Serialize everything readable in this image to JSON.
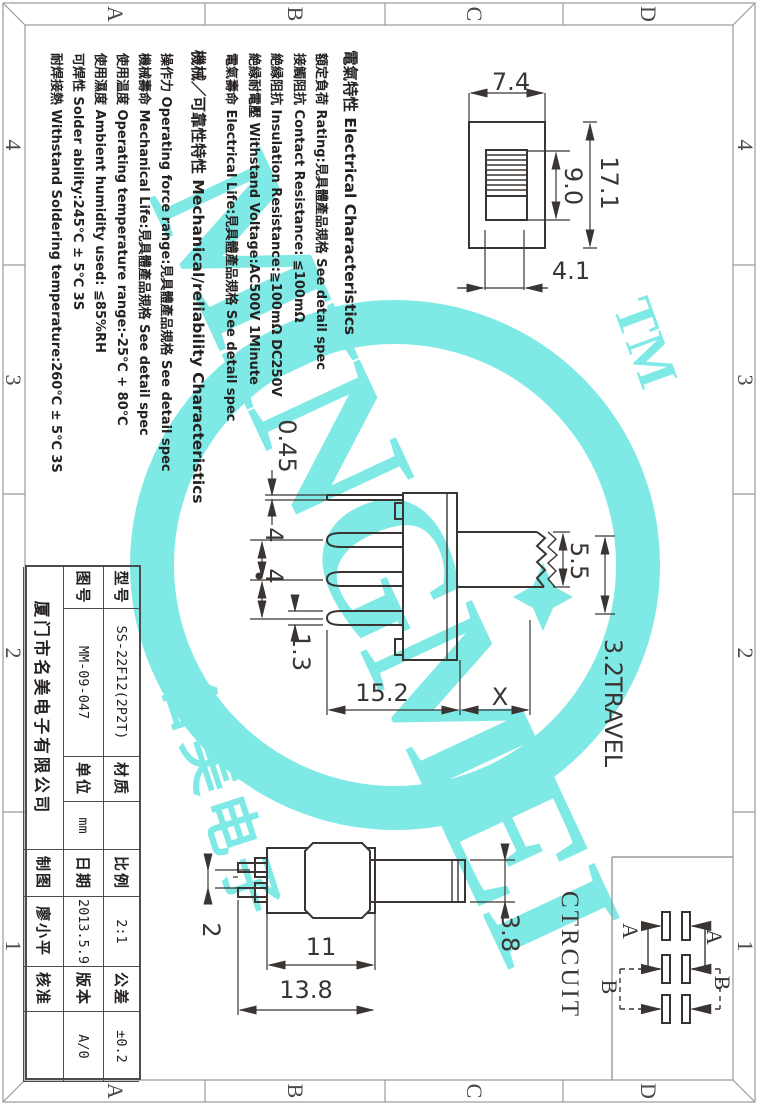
{
  "zones": {
    "cols": [
      "A",
      "B",
      "C",
      "D"
    ],
    "rows": [
      "4",
      "3",
      "2",
      "1"
    ]
  },
  "watermark": {
    "brand": "MINGMEI",
    "tm": "TM",
    "cn": "名美电子",
    "color": "#7fe9e6"
  },
  "specs": {
    "electrical_title": "電氣特性 Electrical Characteristics",
    "electrical": [
      "額定負荷 Rating:見具體產品規格 See detail spec",
      "接觸阻抗 Contact Resistance: ≦100mΩ",
      "絶縁阻抗 Insulation Resistance:≧100mΩ DC250V",
      "絶縁耐電壓 Withstand Voltage:AC500V 1Minute",
      "電氣壽命 Electrical Life:見具體產品規格 See detail spec"
    ],
    "mechanical_title": "機械／可靠性特性 Mechanical/reliability Characteristics",
    "mechanical": [
      "操作力 Operating force range:見具體產品規格 See detail spec",
      "機械壽命 Mechanical Life:見具體產品規格 See detail spec",
      "使用温度 Operating temperature range:-25℃ + 80℃",
      "使用濕度 Ambient humidity used: ≦85%RH",
      "可焊性 Solder ability:245℃ ± 5℃  3S",
      "耐焊接熱 Withstand Soldering temperature:260℃ ± 5℃  3S"
    ]
  },
  "dims": {
    "d74": "7.4",
    "d171": "17.1",
    "d90": "9.0",
    "d41": "4.1",
    "d045": "0.45",
    "d4a": "4",
    "d4b": "4",
    "d13": "1.3",
    "d152": "15.2",
    "dx": "X",
    "d55": "5.5",
    "travel": "3.2TRAVEL",
    "d2": "2",
    "d11": "11",
    "d138": "13.8",
    "d38": "3.8"
  },
  "circuit": {
    "title": "CTRCUIT",
    "a1": "A",
    "a2": "A",
    "b1": "B",
    "b2": "B"
  },
  "title_block": {
    "model_label": "型号",
    "model": "SS-22F12(2P2T)",
    "material_label": "材质",
    "material": "",
    "scale_label": "比例",
    "scale": "2:1",
    "tolerance_label": "公差",
    "tolerance": "±0.2",
    "drawing_no_label": "图号",
    "drawing_no": "MM-09-047",
    "unit_label": "单位",
    "unit": "mm",
    "date_label": "日期",
    "date": "2013.5.9",
    "version_label": "版本",
    "version": "A/0",
    "company": "厦门市名美电子有限公司",
    "drawn_label": "制图",
    "drawn_by": "廖小平",
    "approved_label": "核准",
    "approved": ""
  }
}
